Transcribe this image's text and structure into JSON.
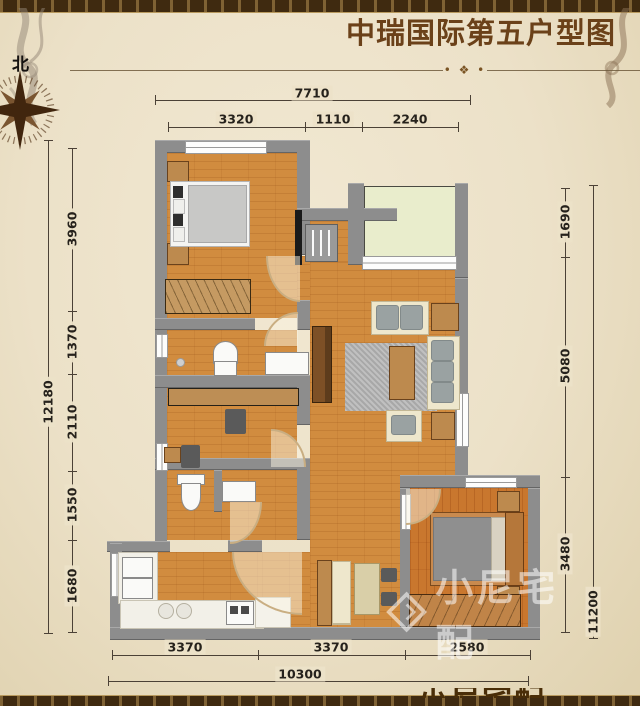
{
  "page": {
    "title": "中瑞国际第五户型图",
    "compass_label": "北",
    "ornament": "• ❖ •"
  },
  "dimensions": {
    "top": {
      "overall": "7710",
      "segments": [
        "3320",
        "1110",
        "2240"
      ]
    },
    "left": {
      "overall": "12180",
      "segments": [
        "3960",
        "1370",
        "2110",
        "1550",
        "1680"
      ]
    },
    "right": {
      "overall": "11200",
      "segments": [
        "1690",
        "5080",
        "3480"
      ]
    },
    "bottom": {
      "overall": "10300",
      "segments": [
        "3370",
        "3370",
        "2580"
      ]
    }
  },
  "watermark": {
    "brand": "小尼宅配"
  },
  "colors": {
    "parchment": "#ece1c8",
    "border_bar": "#3f2a10",
    "title_text": "#6b4119",
    "wall": "#8d8d8d",
    "wood_floor": "#d18c3f",
    "bedroom2_floor": "#c9772e",
    "balcony_floor": "#e9edcc",
    "dimension_text": "#26221c",
    "watermark_white": "rgba(255,255,255,0.55)"
  }
}
